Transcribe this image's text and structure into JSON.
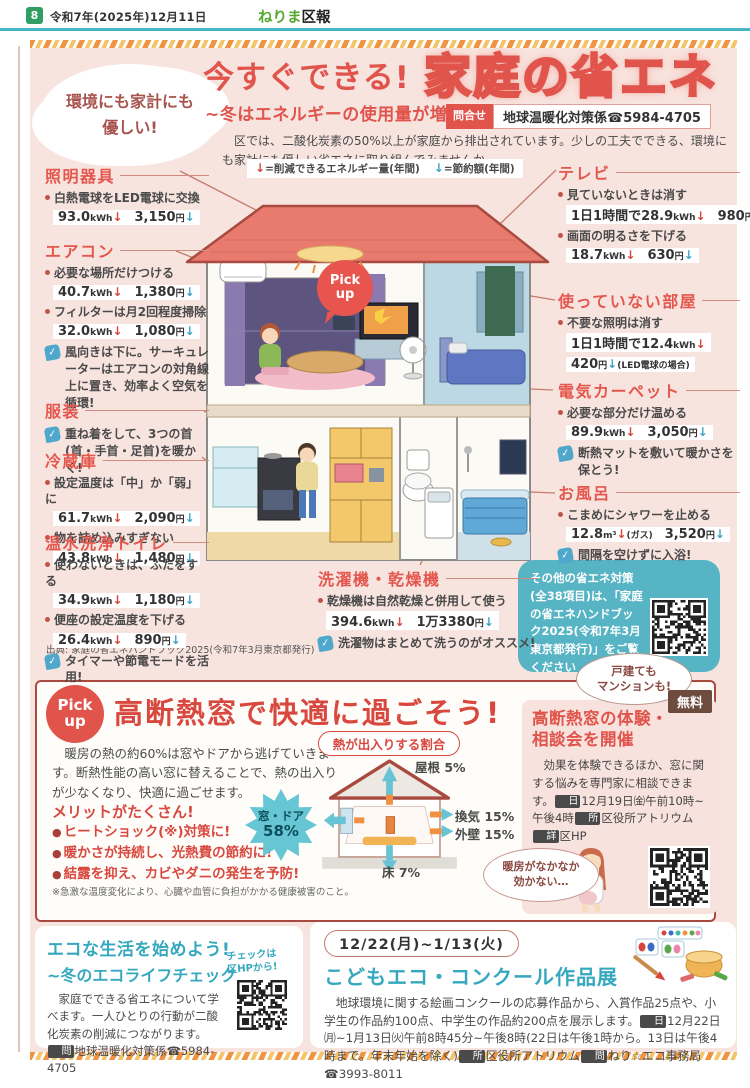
{
  "header": {
    "page_number": "8",
    "date": "令和7年(2025年)12月11日",
    "publication_green": "ねりま",
    "publication_dark": "区報"
  },
  "main": {
    "eyecatch_line1": "環境にも家計にも",
    "eyecatch_line2": "優しい!",
    "title_lead": "今すぐできる!",
    "title_main": "家庭の省エネ",
    "subtitle": "~冬はエネルギーの使用量が増加",
    "contact_badge": "問合せ",
    "contact": "地球温暖化対策係☎5984-4705",
    "intro": "区では、二酸化炭素の50%以上が家庭から排出されています。少しの工夫でできる、環境にも家計にも優しい省エネに取り組んでみませんか。",
    "legend_energy": "=削減できるエネルギー量(年間)",
    "legend_money": "=節約額(年間)",
    "pickup_bubble_line1": "Pick",
    "pickup_bubble_line2": "up",
    "items_left": [
      {
        "title": "照明器具",
        "tips": [
          {
            "text": "白熱電球をLED電球に交換",
            "kwh": "93.0kWh",
            "yen": "3,150円"
          }
        ]
      },
      {
        "title": "エアコン",
        "tips": [
          {
            "text": "必要な場所だけつける",
            "kwh": "40.7kWh",
            "yen": "1,380円"
          },
          {
            "text": "フィルターは月2回程度掃除",
            "kwh": "32.0kWh",
            "yen": "1,080円"
          }
        ],
        "check": "風向きは下に。サーキュレーターはエアコンの対角線上に置き、効率よく空気を循環!"
      },
      {
        "title": "服装",
        "check": "重ね着をして、3つの首(首・手首・足首)を暖かく!"
      },
      {
        "title": "冷蔵庫",
        "tips": [
          {
            "text": "設定温度は「中」か「弱」に",
            "kwh": "61.7kWh",
            "yen": "2,090円"
          },
          {
            "text": "物を詰め込みすぎない",
            "kwh": "43.8kWh",
            "yen": "1,480円"
          }
        ]
      },
      {
        "title": "温水洗浄トイレ",
        "tips": [
          {
            "text": "使わないときは、ふたをする",
            "kwh": "34.9kWh",
            "yen": "1,180円"
          },
          {
            "text": "便座の設定温度を下げる",
            "kwh": "26.4kWh",
            "yen": "890円"
          }
        ],
        "check": "タイマーや節電モードを活用!"
      }
    ],
    "items_right": [
      {
        "title": "テレビ",
        "tips": [
          {
            "text": "見ていないときは消す",
            "kwh": "1日1時間で28.9kWh",
            "yen": "980円"
          },
          {
            "text": "画面の明るさを下げる",
            "kwh": "18.7kWh",
            "yen": "630円"
          }
        ]
      },
      {
        "title": "使っていない部屋",
        "tips": [
          {
            "text": "不要な照明は消す",
            "kwh": "1日1時間で12.4kWh",
            "yen": "420円",
            "yen_suffix": "(LED電球の場合)",
            "stack": true
          }
        ]
      },
      {
        "title": "電気カーペット",
        "tips": [
          {
            "text": "必要な部分だけ温める",
            "kwh": "89.9kWh",
            "yen": "3,050円"
          }
        ],
        "check": "断熱マットを敷いて暖かさを保とう!"
      },
      {
        "title": "お風呂",
        "tips": [
          {
            "text": "こまめにシャワーを止める",
            "kwh": "12.8m³",
            "kwh_suffix": "(ガス)",
            "yen": "3,520円"
          }
        ],
        "check": "間隔を空けずに入浴!"
      }
    ],
    "item_bottom": {
      "title": "洗濯機・乾燥機",
      "tips": [
        {
          "text": "乾燥機は自然乾燥と併用して使う",
          "kwh": "394.6kWh",
          "yen": "1万3380円"
        }
      ],
      "check": "洗濯物はまとめて洗うのがオススメ!"
    },
    "source": "出典: 家庭の省エネハンドブック2025(令和7年3月東京都発行)",
    "handbook_note": "その他の省エネ対策(全38項目)は、「家庭の省エネハンドブック2025(令和7年3月東京都発行)」をご覧ください"
  },
  "pickup": {
    "badge_line1": "Pick",
    "badge_line2": "up",
    "title": "高断熱窓で快適に過ごそう!",
    "top_bubble_line1": "戸建ても",
    "top_bubble_line2": "マンションも!",
    "free_badge": "無料",
    "body": "暖房の熱の約60%は窓やドアから逃げていきます。断熱性能の高い窓に替えることで、熱の出入りが少なくなり、快適に過ごせます。",
    "merits_title": "メリットがたくさん!",
    "merits": [
      "ヒートショック(※)対策に!",
      "暖かさが持続し、光熱費の節約に!",
      "結露を抑え、カビやダニの発生を予防!"
    ],
    "merit_note": "※急激な温度変化により、心臓や血管に負担がかかる健康被害のこと。",
    "diagram": {
      "title": "熱が出入りする割合",
      "roof": "屋根 5%",
      "vent": "換気 15%",
      "wall": "外壁 15%",
      "floor": "床 7%",
      "window_room": "窓・ドア",
      "window_pct": "58%"
    },
    "event": {
      "title_line1": "高断熱窓の体験・",
      "title_line2": "相談会を開催",
      "body_segments": [
        {
          "t": "効果を体験できるほか、窓に関する悩みを専門家に相談できます。"
        },
        {
          "icon": "日"
        },
        {
          "t": "12月19日㈮午前10時~午後4時"
        },
        {
          "icon": "所"
        },
        {
          "t": "区役所アトリウム"
        },
        {
          "icon": "詳"
        },
        {
          "t": "区HP"
        }
      ],
      "bubble_line1": "暖房がなかなか",
      "bubble_line2": "効かない…"
    }
  },
  "eco_check": {
    "title": "エコな生活を始めよう!",
    "subtitle": "~冬のエコライフチェック",
    "body_segments": [
      {
        "t": "家庭でできる省エネについて学べます。一人ひとりの行動が二酸化炭素の削減につながります。"
      },
      {
        "icon": "問"
      },
      {
        "t": "地球温暖化対策係☎5984-4705"
      }
    ],
    "qr_note_line1": "チェックは",
    "qr_note_line2": "区HPから!"
  },
  "contest": {
    "date": "12/22(月)~1/13(火)",
    "title": "こどもエコ・コンクール作品展",
    "body_segments": [
      {
        "t": "地球環境に関する絵画コンクールの応募作品から、入賞作品25点や、小学生の作品約100点、中学生の作品約200点を展示します。"
      },
      {
        "icon": "日"
      },
      {
        "t": "12月22日㈪~1月13日㈫午前8時45分~午後8時(22日は午後1時から。13日は午後4時まで。年末年始を除く)"
      },
      {
        "icon": "所"
      },
      {
        "t": "区役所アトリウム"
      },
      {
        "icon": "問"
      },
      {
        "t": "ねり☆エコ事務局☎3993-8011"
      }
    ]
  },
  "colors": {
    "accent_red": "#e0544c",
    "teal_heading": "#35a8bf",
    "handbook_box": "#56b4c4",
    "free_badge": "#6d4b3e",
    "arrow_energy_red": "#d9453a",
    "arrow_money_blue": "#3da4c8",
    "roof": "#e87a6e"
  }
}
